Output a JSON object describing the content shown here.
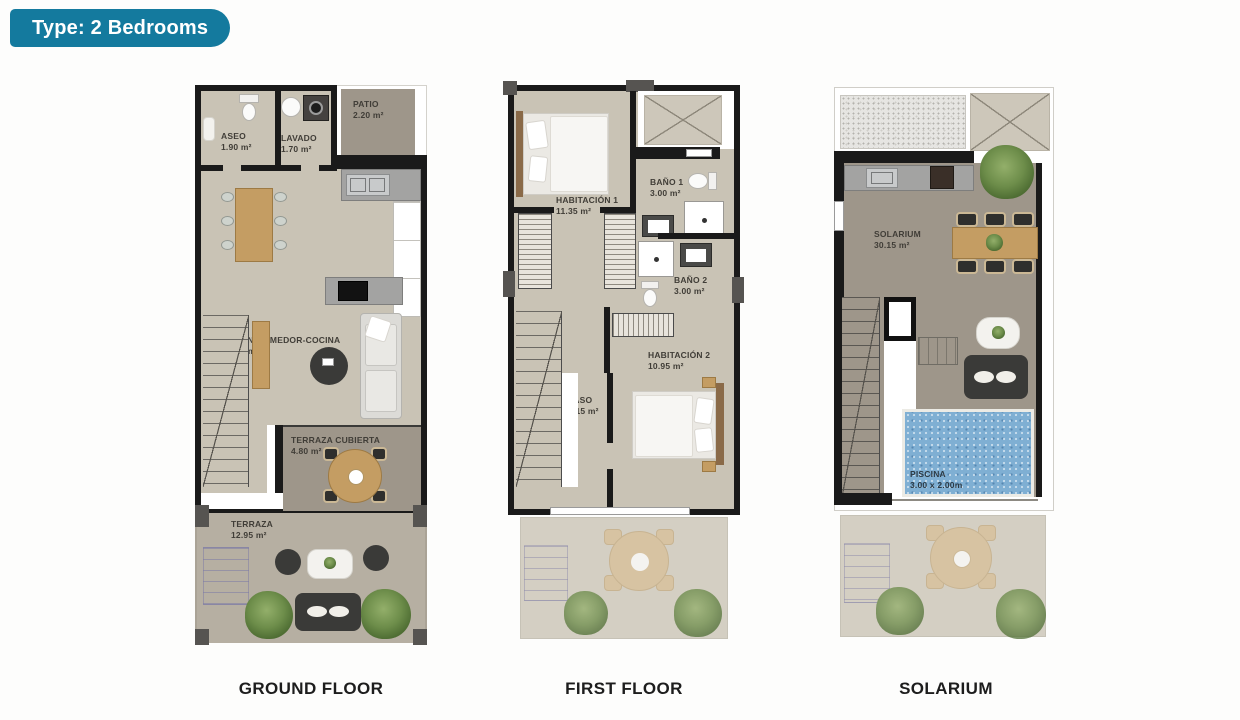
{
  "badge": {
    "label": "Type: 2 Bedrooms"
  },
  "colors": {
    "badge_bg": "#147a9e",
    "wall": "#1a1a1a",
    "floor": "#c9c3b5",
    "terrace": "#9e968a",
    "pool": "#7fafd3"
  },
  "plans": [
    {
      "id": "ground-floor",
      "caption": "GROUND FLOOR",
      "rooms": [
        {
          "name": "ASEO",
          "area": "1.90 m²"
        },
        {
          "name": "LAVADO",
          "area": "1.70 m²"
        },
        {
          "name": "PATIO",
          "area": "2.20 m²"
        },
        {
          "name": "SALON-COMEDOR-COCINA",
          "area": "30.20 m²"
        },
        {
          "name": "TERRAZA CUBIERTA",
          "area": "4.80 m²"
        },
        {
          "name": "TERRAZA",
          "area": "12.95 m²"
        }
      ]
    },
    {
      "id": "first-floor",
      "caption": "FIRST FLOOR",
      "rooms": [
        {
          "name": "HABITACIÓN 1",
          "area": "11.35 m²"
        },
        {
          "name": "BAÑO 1",
          "area": "3.00 m²"
        },
        {
          "name": "BAÑO 2",
          "area": "3.00 m²"
        },
        {
          "name": "HABITACIÓN 2",
          "area": "10.95 m²"
        },
        {
          "name": "PASO",
          "area": "4.15 m²"
        }
      ]
    },
    {
      "id": "solarium",
      "caption": "SOLARIUM",
      "rooms": [
        {
          "name": "SOLARIUM",
          "area": "30.15 m²"
        },
        {
          "name": "PISCINA",
          "area": "3.00 x 2.00m"
        }
      ]
    }
  ]
}
